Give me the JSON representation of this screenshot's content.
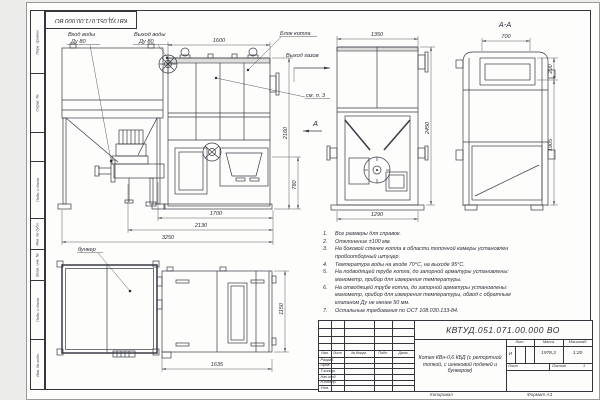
{
  "frame": {
    "stamp_number": "КВТУД.051.071.00.000 ВО",
    "margin_labels": [
      "Перв. примен.",
      "Справ. №",
      "",
      "Подп. и дата",
      "Инв. № дубл.",
      "Взам. инв. №",
      "Подп. и дата",
      "Инв. № подл."
    ],
    "footer": {
      "copied": "Копировал",
      "format": "Формат А3"
    }
  },
  "labels": {
    "water_in_1": "Вход воды",
    "water_in_2": "Ду 80",
    "water_out_1": "Выход воды",
    "water_out_2": "Ду 80",
    "boiler_block": "Блок котла",
    "gas_out": "Выход газов",
    "see_note": "см. п. 3",
    "view_a": "А",
    "section_aa": "А-А",
    "bunker": "бункер"
  },
  "dims": {
    "front_width": "1600",
    "front_height": "2160",
    "conveyor_height": "780",
    "chain_1700": "1700",
    "chain_2130": "2130",
    "chain_3250": "3250",
    "rear_width": "1350",
    "rear_height": "2450",
    "rear_base": "1290",
    "section_width": "700",
    "section_top": "200",
    "section_body": "1905",
    "plan_length": "1635",
    "plan_width": "1150"
  },
  "notes": [
    {
      "n": "1.",
      "t": "Все размеры для справок."
    },
    {
      "n": "2.",
      "t": "Отклонение ±100 мм."
    },
    {
      "n": "3.",
      "t": "На боковой стенке котла в области топочной камеры установлен пробоотборный штуцер."
    },
    {
      "n": "4.",
      "t": "Температура воды на входе 70°С, на выходе 95°С."
    },
    {
      "n": "5.",
      "t": "На подводящей трубе котла, до запорной арматуры установлены: манометр, прибор для измерения температуры."
    },
    {
      "n": "6.",
      "t": "На отводящей трубе котла, до запорной арматуры установлены: манометр, прибор для измерения температуры, обвод с обратным клапаном Ду не менее 50 мм."
    },
    {
      "n": "7.",
      "t": "Остальные требования по ОСТ 108.030.133-84."
    }
  ],
  "title_block": {
    "doc_number": "КВТУД.051.071.00.000 ВО",
    "name": "Котел КВн-0,6 КБД (с ретортной топкой, с шнековой подачей и бункером)",
    "columns": [
      "Изм.",
      "Лист",
      "№ докум.",
      "Подп.",
      "Дата"
    ],
    "rows": [
      "Разраб.",
      "Пров.",
      "Т.контр.",
      "Нач.отд.",
      "Н.контр.",
      "Утв."
    ],
    "lit_header": "Лит.",
    "lit_value": "И",
    "mass_header": "Масса",
    "mass_value": "1978,3",
    "scale_header": "Масштаб",
    "scale_value": "1:20",
    "sheet_label": "Лист",
    "sheets_label": "Листов",
    "sheets_value": "1"
  }
}
